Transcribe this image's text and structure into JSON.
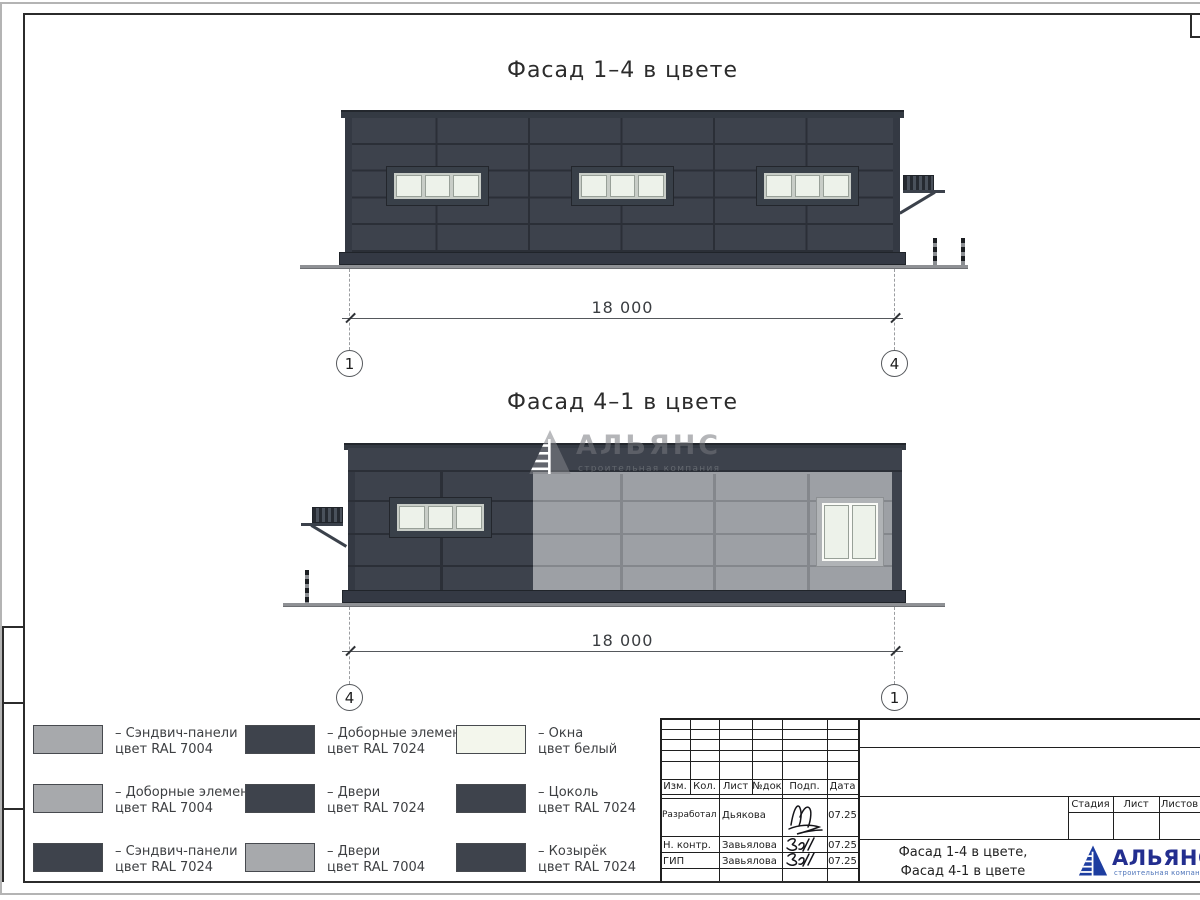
{
  "sheet": {
    "facade1": {
      "title": "Фасад 1–4 в цвете",
      "dimension": "18 000",
      "axis_left": "1",
      "axis_right": "4"
    },
    "facade2": {
      "title": "Фасад 4–1 в цвете",
      "dimension": "18 000",
      "axis_left": "4",
      "axis_right": "1"
    }
  },
  "watermark": {
    "name": "АЛЬЯНС",
    "tagline": "строительная компания"
  },
  "legend": {
    "items": [
      {
        "swatch": "RAL 7004 light gray",
        "line1": "– Сэндвич-панели",
        "line2": "цвет RAL 7004"
      },
      {
        "swatch": "RAL 7004 light gray",
        "line1": "– Доборные элементы",
        "line2": "цвет RAL 7004"
      },
      {
        "swatch": "RAL 7024 dark gray",
        "line1": "– Сэндвич-панели",
        "line2": "цвет RAL 7024"
      },
      {
        "swatch": "RAL 7024 dark gray",
        "line1": "– Доборные элементы",
        "line2": "цвет RAL 7024"
      },
      {
        "swatch": "RAL 7024 dark gray",
        "line1": "– Двери",
        "line2": "цвет RAL 7024"
      },
      {
        "swatch": "RAL 7004 light gray",
        "line1": "– Двери",
        "line2": "цвет RAL 7004"
      },
      {
        "swatch": "white",
        "line1": "– Окна",
        "line2": "цвет белый"
      },
      {
        "swatch": "RAL 7024 dark gray",
        "line1": "– Цоколь",
        "line2": "цвет RAL 7024"
      },
      {
        "swatch": "RAL 7024 dark gray",
        "line1": "– Козырёк",
        "line2": "цвет RAL 7024"
      }
    ]
  },
  "titleblock": {
    "columns": [
      "Изм.",
      "Кол.",
      "Лист",
      "№док",
      "Подп.",
      "Дата"
    ],
    "rows": [
      {
        "role": "Разработал",
        "name": "Дьякова",
        "date": "07.25"
      },
      {
        "role": "Н. контр.",
        "name": "Завьялова",
        "date": "07.25"
      },
      {
        "role": "ГИП",
        "name": "Завьялова",
        "date": "07.25"
      }
    ],
    "stage_label": "Стадия",
    "sheet_label": "Лист",
    "sheets_label": "Листов",
    "doc_line1": "Фасад 1-4 в цвете,",
    "doc_line2": "Фасад 4-1 в цвете",
    "logo": {
      "name": "АЛЬЯНС",
      "tagline": "строительная компания"
    }
  },
  "colors": {
    "ral7024": "#3e434c",
    "ral7004": "#a7a9ac",
    "window_white": "#f3f6ec",
    "logo_blue": "#232e8f"
  }
}
